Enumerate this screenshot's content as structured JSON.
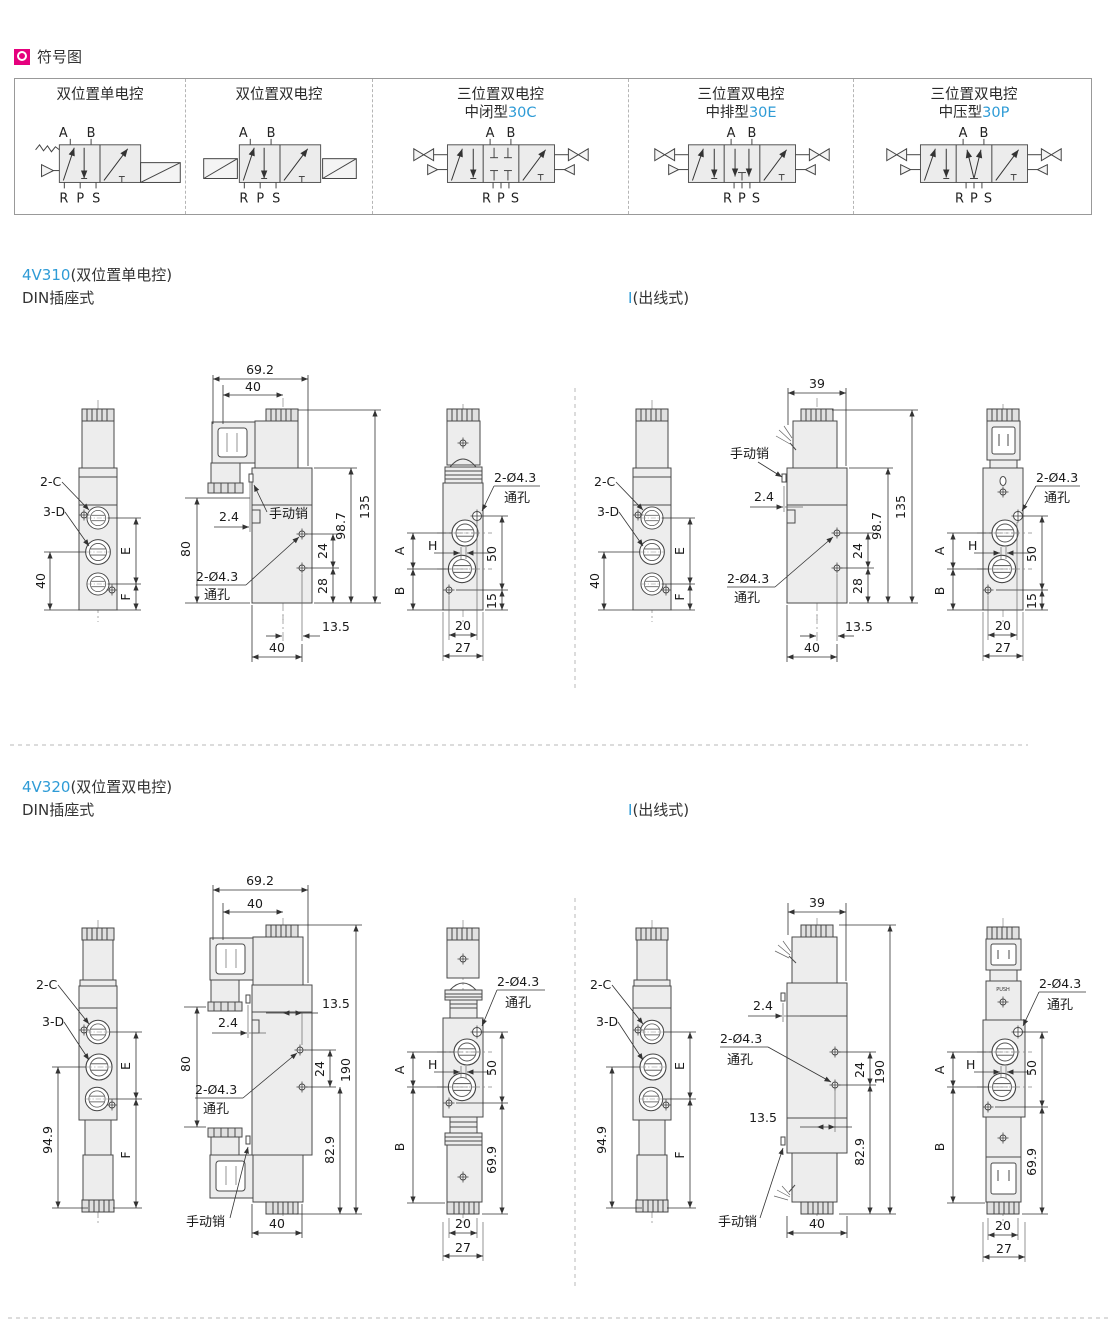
{
  "colors": {
    "accent_blue": "#2E9BD6",
    "icon_magenta": "#E5007D"
  },
  "header": {
    "title": "符号图"
  },
  "symbol_panel": {
    "columns": [
      {
        "title": "双位置单电控",
        "sub_plain": "",
        "sub_code": "",
        "a": "A",
        "b": "B",
        "rps": "R P S"
      },
      {
        "title": "双位置双电控",
        "sub_plain": "",
        "sub_code": "",
        "a": "A",
        "b": "B",
        "rps": "R P S"
      },
      {
        "title": "三位置双电控",
        "sub_plain": "中闭型",
        "sub_code": "30C",
        "a": "A",
        "b": "B",
        "rps": "R P S"
      },
      {
        "title": "三位置双电控",
        "sub_plain": "中排型",
        "sub_code": "30E",
        "a": "A",
        "b": "B",
        "rps": "R P S"
      },
      {
        "title": "三位置双电控",
        "sub_plain": "中压型",
        "sub_code": "30P",
        "a": "A",
        "b": "B",
        "rps": "R P S"
      }
    ]
  },
  "s310": {
    "model": "4V310",
    "model_suffix": "(双位置单电控)",
    "din_label": "DIN插座式",
    "out_label_prefix": "I",
    "out_label_suffix": "(出线式)",
    "front": {
      "c": "2-C",
      "d": "3-D",
      "h40": "40",
      "e": "E",
      "f": "F"
    },
    "side": {
      "w692": "69.2",
      "w40": "40",
      "h80": "80",
      "pin": "手动销",
      "off24": "2.4",
      "hole1": "2-Ø4.3",
      "hole2": "通孔",
      "h135": "135",
      "h987": "98.7",
      "d24": "24",
      "d28": "28",
      "d135": "13.5",
      "w40b": "40",
      "w39": "39"
    },
    "end": {
      "hole1": "2-Ø4.3",
      "hole2": "通孔",
      "a": "A",
      "b": "B",
      "h": "H",
      "d50": "50",
      "d15": "15",
      "d20": "20",
      "d27": "27"
    }
  },
  "s320": {
    "model": "4V320",
    "model_suffix": "(双位置双电控)",
    "din_label": "DIN插座式",
    "out_label_prefix": "I",
    "out_label_suffix": "(出线式)",
    "front": {
      "c": "2-C",
      "d": "3-D",
      "h949": "94.9",
      "e": "E",
      "f": "F"
    },
    "side": {
      "w692": "69.2",
      "w40": "40",
      "h80": "80",
      "pin": "手动销",
      "off24": "2.4",
      "hole1": "2-Ø4.3",
      "hole2": "通孔",
      "d135": "13.5",
      "d24": "24",
      "h190": "190",
      "h829": "82.9",
      "w40b": "40",
      "w39": "39"
    },
    "end": {
      "hole1": "2-Ø4.3",
      "hole2": "通孔",
      "a": "A",
      "b": "B",
      "h": "H",
      "d50": "50",
      "d699": "69.9",
      "d20": "20",
      "d27": "27",
      "push": "PUSH"
    }
  }
}
